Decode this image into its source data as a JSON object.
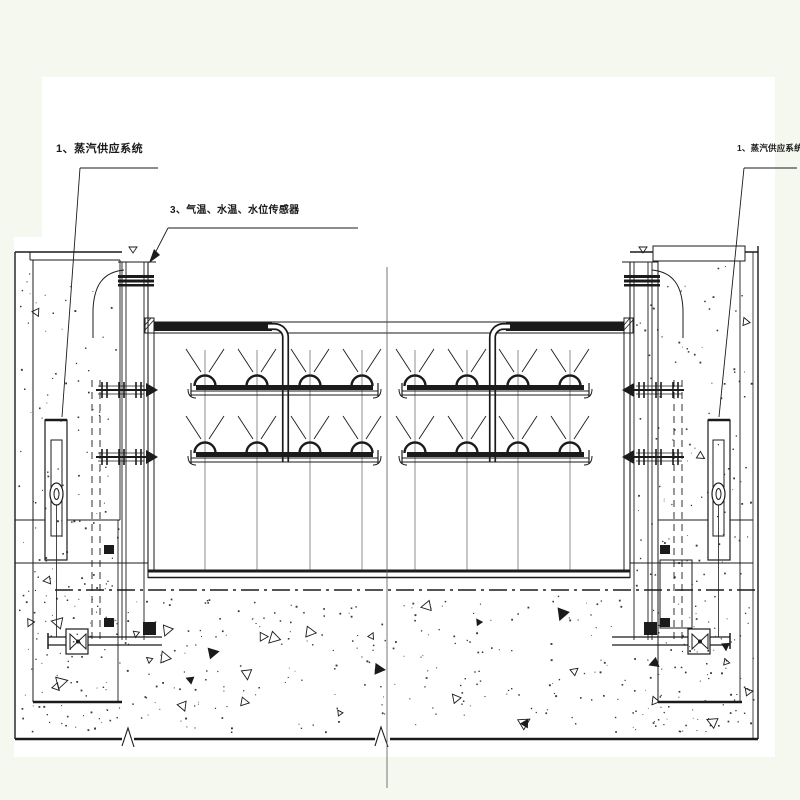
{
  "page": {
    "background": "#ffffff",
    "margin_color": "#f5f8ef",
    "ink_color": "#1b1b1b"
  },
  "labels": {
    "steam_supply_left": "1、蒸汽供应系统",
    "sensors_mid": "3、气温、水温、水位传感器",
    "steam_supply_right": "1、蒸汽供应系统"
  },
  "figure": {
    "type": "engineering-section-drawing",
    "spray_bar_groups": 2,
    "spray_bar_rows_per_group": 2,
    "nozzles_per_bar": 4,
    "shutoff_valves": 2,
    "steam_cylinders": 2
  }
}
